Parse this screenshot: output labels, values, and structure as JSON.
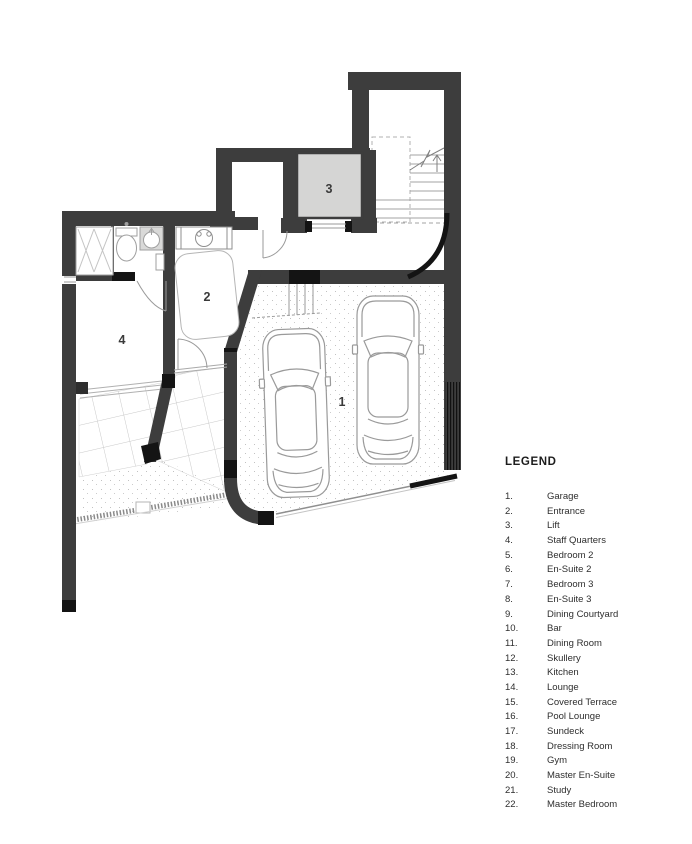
{
  "plan": {
    "room_labels": {
      "garage": "1",
      "entrance": "2",
      "lift": "3",
      "staff_quarters": "4"
    }
  },
  "legend": {
    "title": "LEGEND",
    "items": [
      {
        "n": "1.",
        "name": "Garage"
      },
      {
        "n": "2.",
        "name": "Entrance"
      },
      {
        "n": "3.",
        "name": "Lift"
      },
      {
        "n": "4.",
        "name": "Staff Quarters"
      },
      {
        "n": "5.",
        "name": "Bedroom 2"
      },
      {
        "n": "6.",
        "name": "En-Suite 2"
      },
      {
        "n": "7.",
        "name": "Bedroom 3"
      },
      {
        "n": "8.",
        "name": "En-Suite 3"
      },
      {
        "n": "9.",
        "name": "Dining Courtyard"
      },
      {
        "n": "10.",
        "name": "Bar"
      },
      {
        "n": "11.",
        "name": "Dining Room"
      },
      {
        "n": "12.",
        "name": "Skullery"
      },
      {
        "n": "13.",
        "name": "Kitchen"
      },
      {
        "n": "14.",
        "name": "Lounge"
      },
      {
        "n": "15.",
        "name": "Covered Terrace"
      },
      {
        "n": "16.",
        "name": "Pool Lounge"
      },
      {
        "n": "17.",
        "name": "Sundeck"
      },
      {
        "n": "18.",
        "name": "Dressing Room"
      },
      {
        "n": "19.",
        "name": "Gym"
      },
      {
        "n": "20.",
        "name": "Master En-Suite"
      },
      {
        "n": "21.",
        "name": "Study"
      },
      {
        "n": "22.",
        "name": "Master Bedroom"
      }
    ]
  },
  "colors": {
    "wall": "#3d3d3d",
    "accent_black": "#141414",
    "lift_fill": "#d5d5d4",
    "thin_line": "#9a9a9a",
    "tile_line": "#c9c9c9",
    "text": "#2e2e2e"
  }
}
